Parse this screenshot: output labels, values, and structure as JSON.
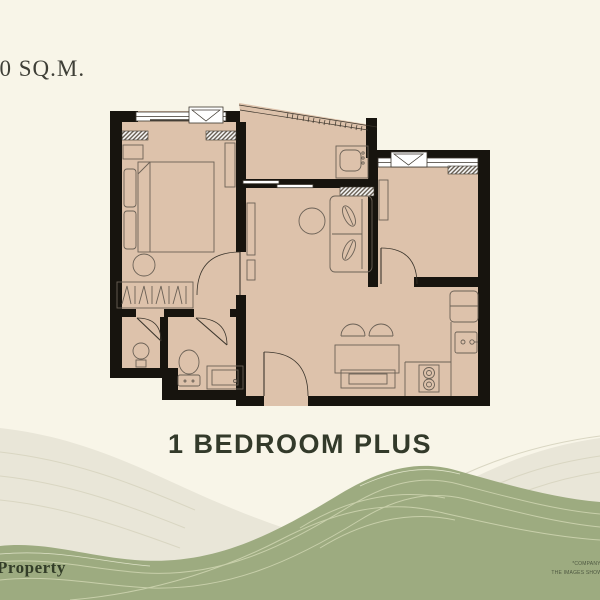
{
  "colors": {
    "background": "#f8f5e8",
    "floor": "#ddc2ab",
    "wall": "#17140e",
    "line": "#6b6156",
    "dark": "#3b352c",
    "green_wave": "#9dab80",
    "green_contour": "#c8cfaa",
    "light_wave": "#e9e6d8",
    "light_contour": "#d9d6c2",
    "title_color": "#333a2a",
    "brand_color": "#333d28",
    "disclaimer_color": "#4e5841",
    "area_color": "#3f3f37"
  },
  "area_label": {
    "text": "00 SQ.M."
  },
  "title": {
    "text": "1 BEDROOM PLUS"
  },
  "footer": {
    "brand": "Property",
    "disclaimer_line1": "*COMPANY RESERVES THE RI",
    "disclaimer_line2": "THE IMAGES SHOWN ARE COMPUTER"
  }
}
